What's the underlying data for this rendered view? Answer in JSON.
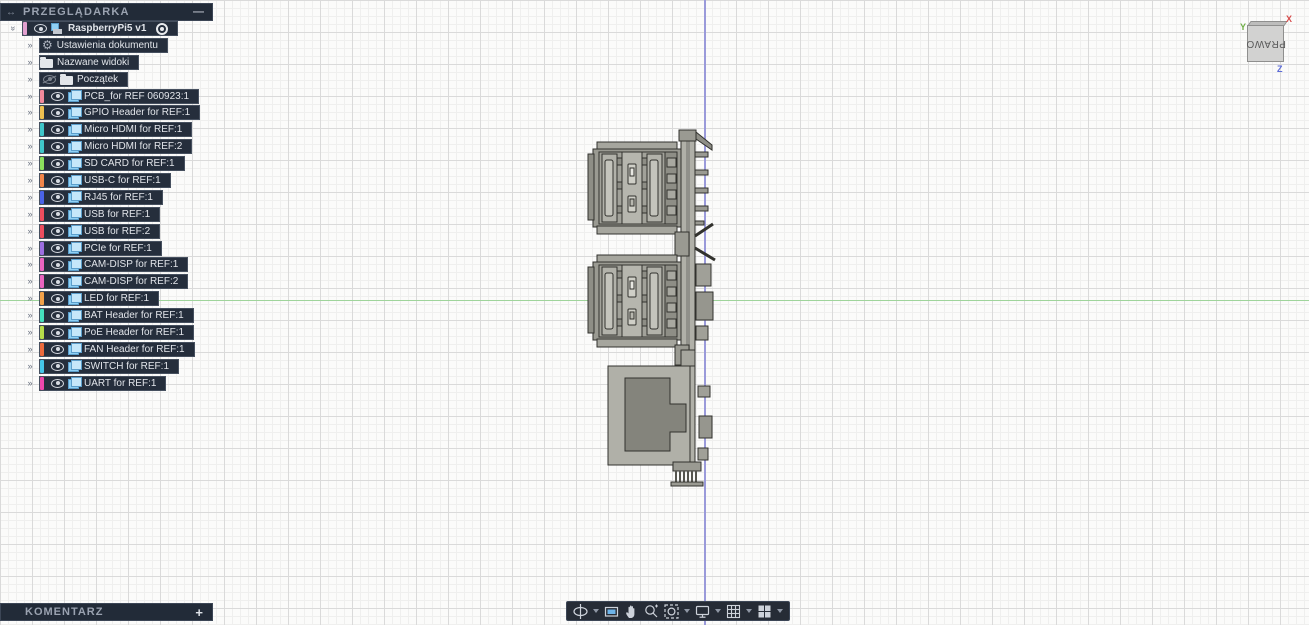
{
  "icons": {
    "dock": "↔",
    "minimize": "—",
    "add": "+",
    "expand_chevron": "»",
    "gear": "⚙"
  },
  "browser_panel": {
    "title": "PRZEGLĄDARKA",
    "root_label": "RaspberryPi5 v1",
    "root_color": "#e2a0cf",
    "doc_settings_label": "Ustawienia dokumentu",
    "named_views_label": "Nazwane widoki",
    "origin_label": "Początek",
    "components": [
      {
        "label": "PCB_for REF 060923:1",
        "color": "#f2899b"
      },
      {
        "label": "GPIO Header for REF:1",
        "color": "#eec050"
      },
      {
        "label": "Micro HDMI for REF:1",
        "color": "#3fc6c9"
      },
      {
        "label": "Micro HDMI for REF:2",
        "color": "#3fc6c9"
      },
      {
        "label": "SD CARD for REF:1",
        "color": "#8ce05e"
      },
      {
        "label": "USB-C for REF:1",
        "color": "#f2854a"
      },
      {
        "label": "RJ45 for REF:1",
        "color": "#4a63e8"
      },
      {
        "label": "USB for REF:1",
        "color": "#ee4d5e"
      },
      {
        "label": "USB for REF:2",
        "color": "#ee4d5e"
      },
      {
        "label": "PCIe for REF:1",
        "color": "#9d6ee0"
      },
      {
        "label": "CAM-DISP for REF:1",
        "color": "#ea64c0"
      },
      {
        "label": "CAM-DISP for REF:2",
        "color": "#ea64c0"
      },
      {
        "label": "LED for REF:1",
        "color": "#f2a24a"
      },
      {
        "label": "BAT Header for REF:1",
        "color": "#45e0be"
      },
      {
        "label": "PoE Header for REF:1",
        "color": "#b5dc4a"
      },
      {
        "label": "FAN Header for REF:1",
        "color": "#ec6a3c"
      },
      {
        "label": "SWITCH for REF:1",
        "color": "#45c6ea"
      },
      {
        "label": "UART for REF:1",
        "color": "#ee47ac"
      }
    ]
  },
  "comments_panel": {
    "title": "KOMENTARZ"
  },
  "navbar": {
    "tools": [
      {
        "name": "orbit",
        "dropdown": true
      },
      {
        "name": "look-at",
        "dropdown": false
      },
      {
        "name": "pan",
        "dropdown": false
      },
      {
        "name": "zoom",
        "dropdown": false
      },
      {
        "name": "fit",
        "dropdown": true
      },
      {
        "name": "display-settings",
        "dropdown": true
      },
      {
        "name": "grid-and-snaps",
        "dropdown": true
      },
      {
        "name": "viewports",
        "dropdown": true
      }
    ]
  },
  "viewcube": {
    "face_label": "PRAWO",
    "axis_x": "X",
    "axis_y": "Y",
    "axis_z": "Z",
    "axis_x_color": "#d64b4b",
    "axis_y_color": "#6fae46",
    "axis_z_color": "#5c6bd6"
  },
  "canvas_colors": {
    "horizontal_axis_line": "#9fd49b",
    "vertical_axis_line": "#9a9ada",
    "panel_background": "#222b38"
  }
}
